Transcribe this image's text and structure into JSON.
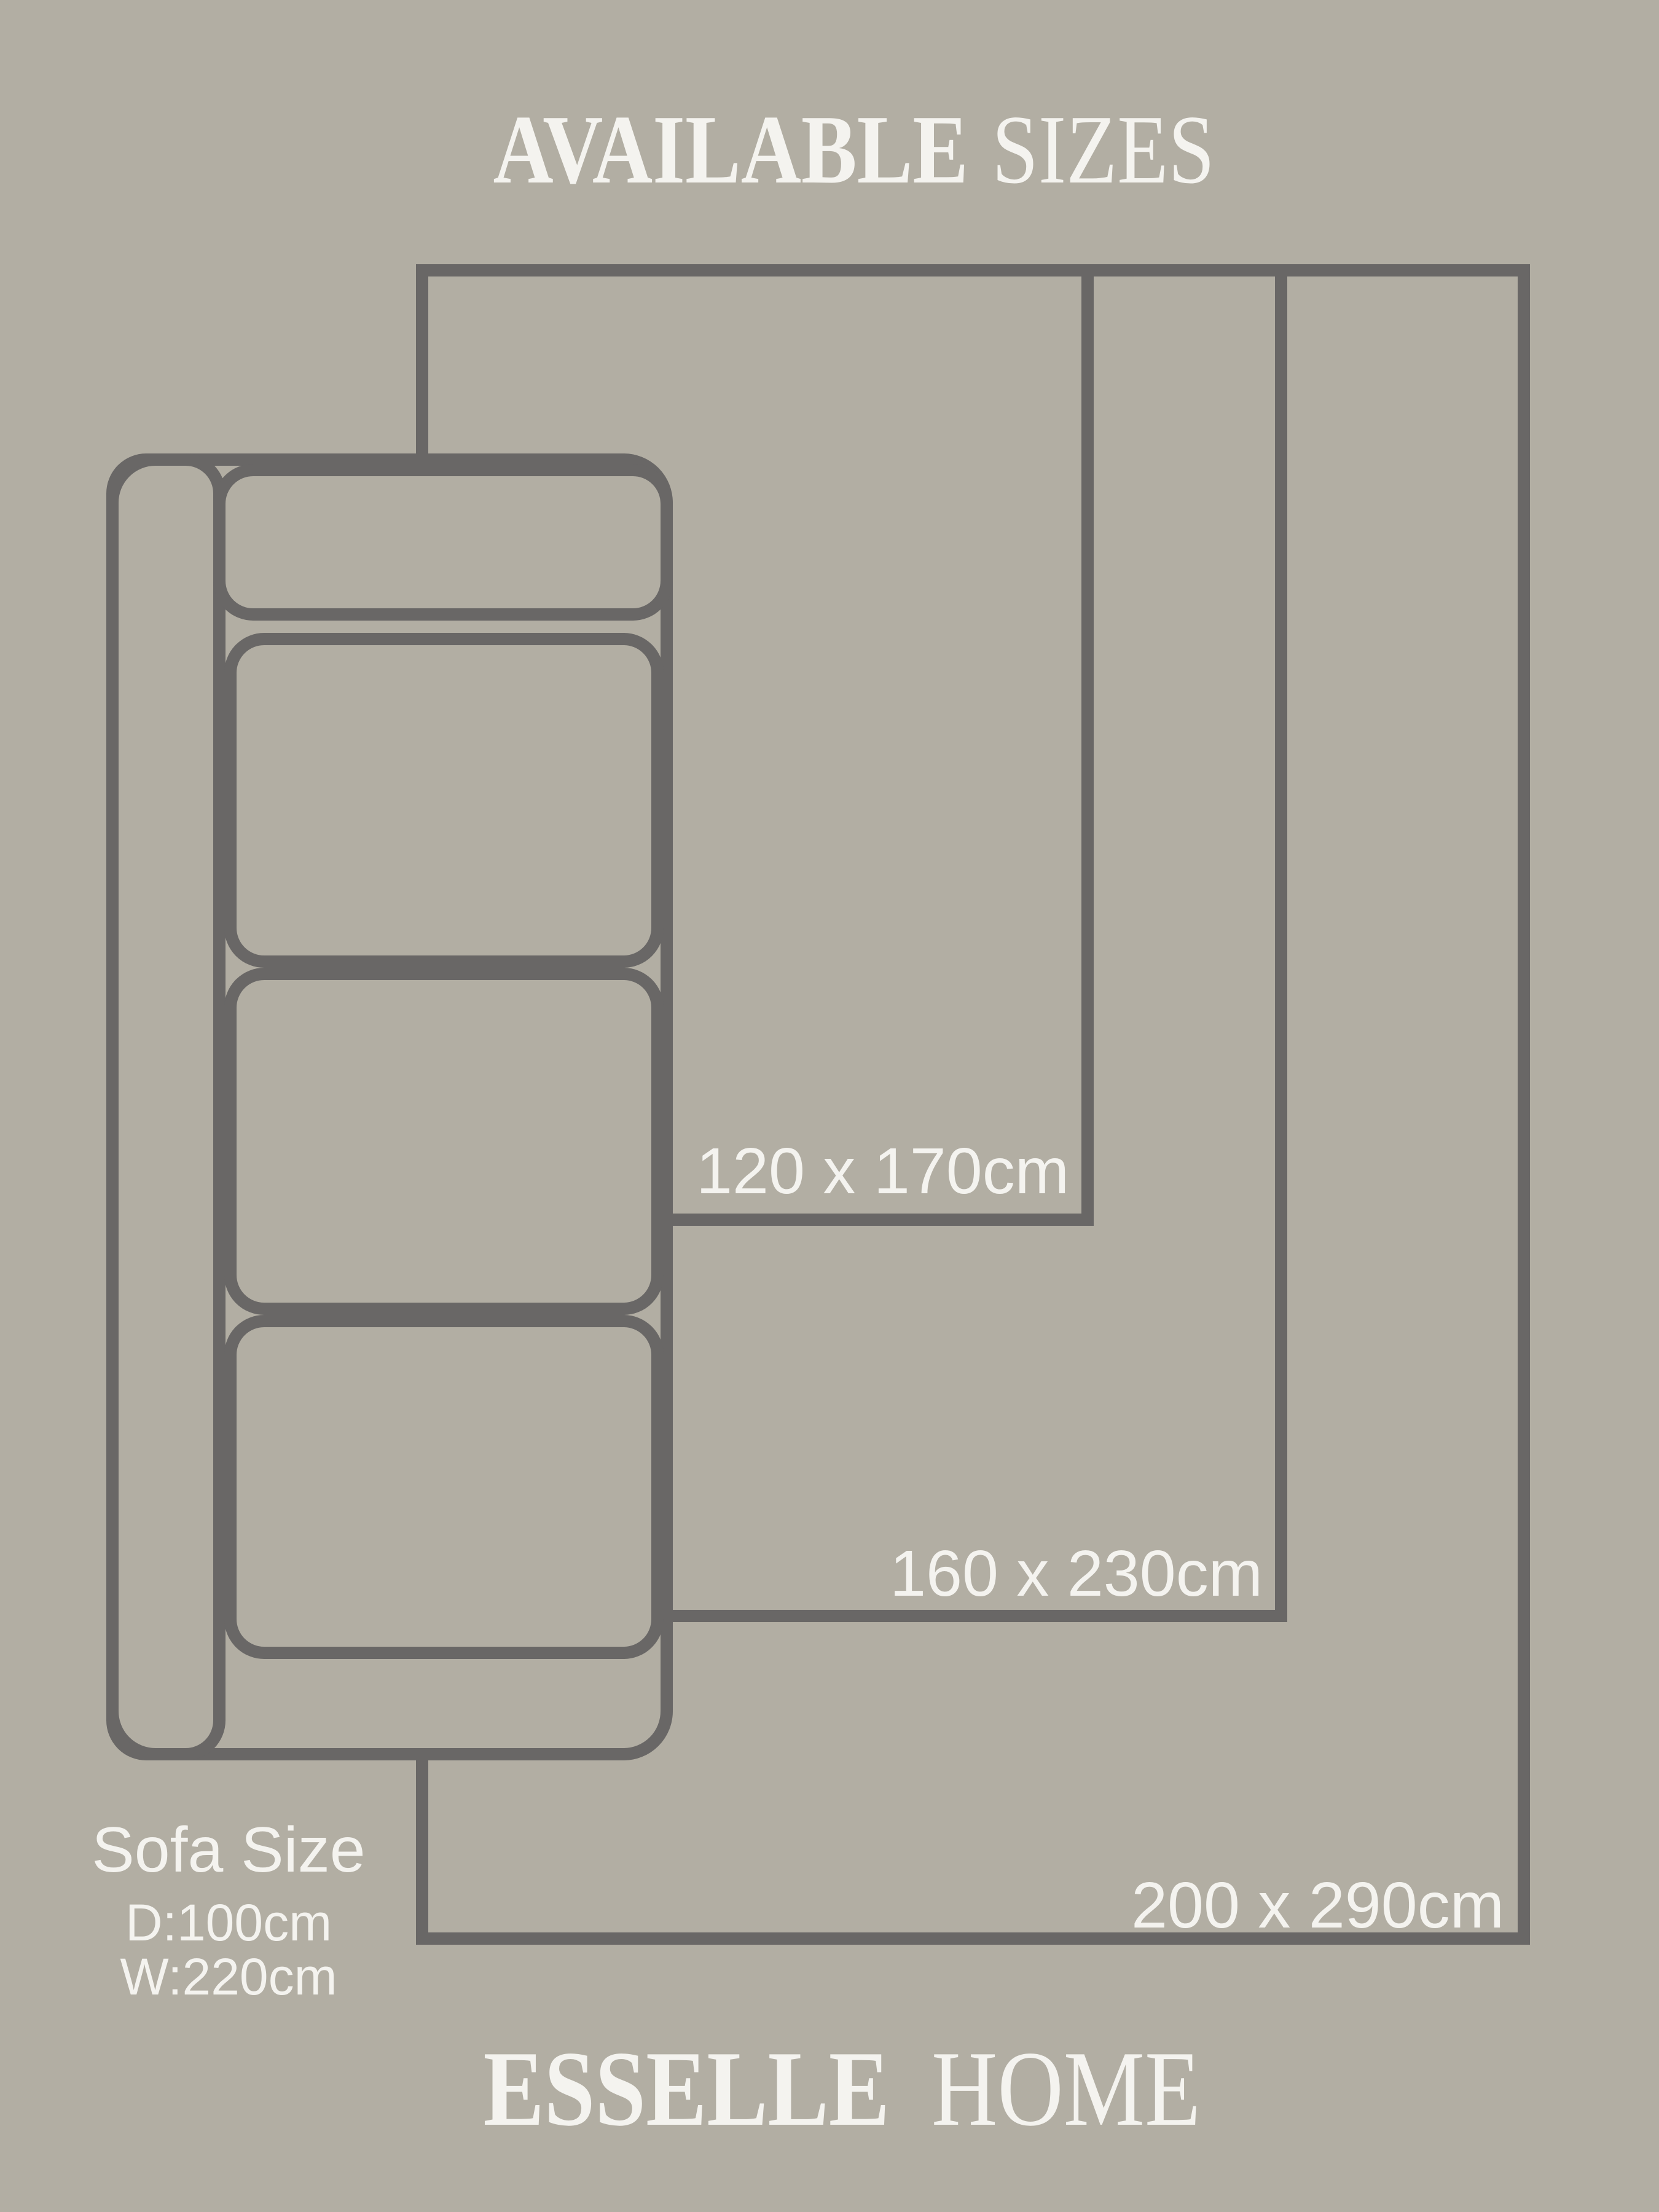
{
  "title": {
    "word1": "AVAILABLE",
    "word2": "SIZES"
  },
  "sizes": [
    {
      "label": "120 x 170cm"
    },
    {
      "label": "160 x 230cm"
    },
    {
      "label": "200 x 290cm"
    }
  ],
  "sofa": {
    "title": "Sofa Size",
    "depth": "D:100cm",
    "width": "W:220cm"
  },
  "brand": {
    "word1": "ESSELLE",
    "word2": "HOME"
  },
  "colors": {
    "background": "#b2aea3",
    "line": "#696766",
    "text": "#f4f3ef"
  }
}
